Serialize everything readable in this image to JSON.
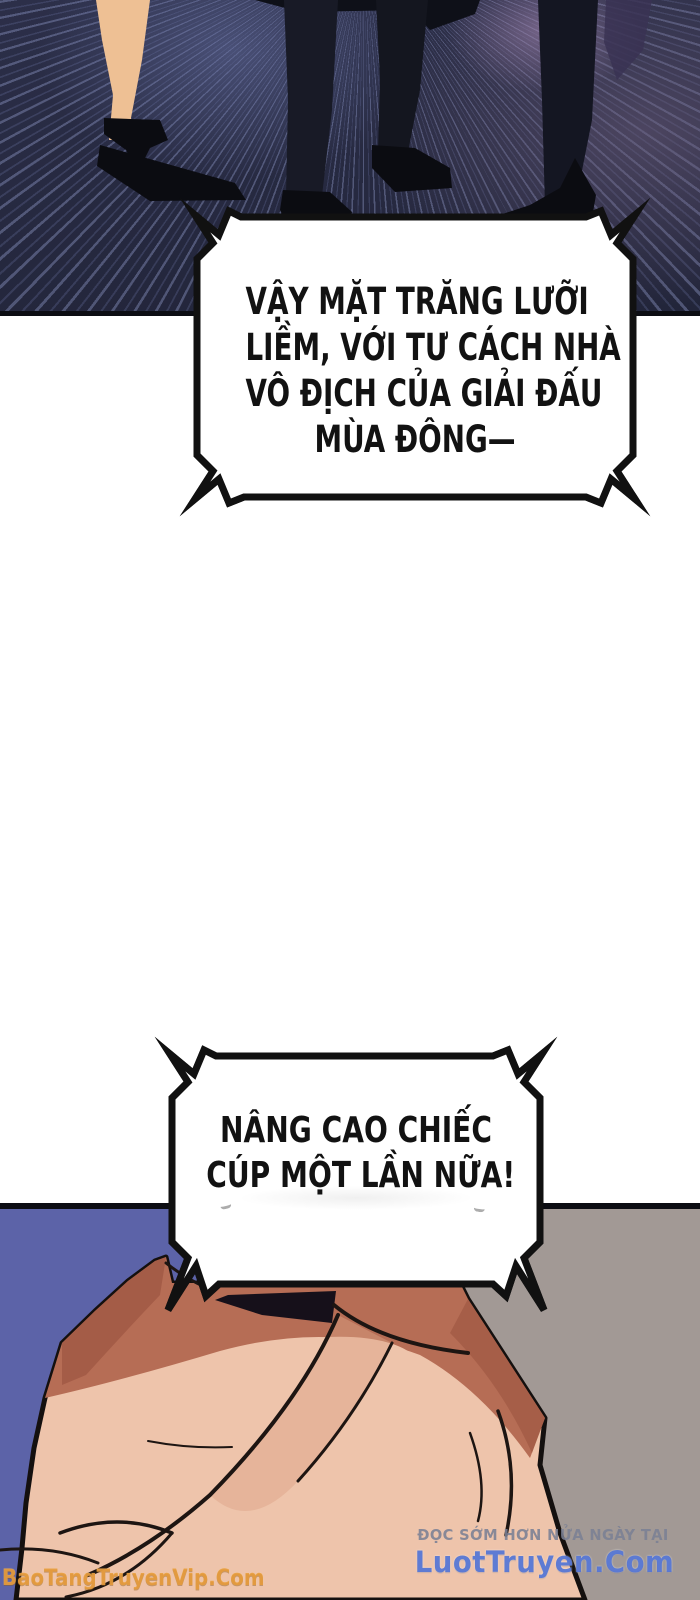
{
  "bubbles": [
    {
      "lines": [
        "VẬY MẶT TRĂNG LƯỠI",
        "LIỀM, VỚI TƯ CÁCH NHÀ",
        "VÔ ĐỊCH CỦA GIẢI ĐẤU",
        "MÙA ĐÔNG—"
      ]
    },
    {
      "lines": [
        "NÂNG CAO CHIẾC",
        "CÚP MỘT LẦN NỮA!"
      ]
    }
  ],
  "watermarks": {
    "reader_site_tagline": "ĐỌC SỚM HƠN NỬA NGÀY TẠI",
    "reader_site_name": "LuotTruyen.Com",
    "scan_site_name": "BaoTangTruyenVip.Com"
  },
  "colors": {
    "floor_dark": "#262a41",
    "floor_streak": "#8e98c6",
    "floor_purple": "#6a5b79",
    "silhouette_black": "#0b0c11",
    "bare_leg_skin": "#eec094",
    "panel_blue": "#5c63a8",
    "panel_gray": "#a29995",
    "fist_skin_light": "#eec4ab",
    "fist_skin_red": "#b66d55",
    "watermark_orange": "#e69a3a",
    "watermark_blue": "#5273d2",
    "watermark_gray": "#7a8094"
  }
}
